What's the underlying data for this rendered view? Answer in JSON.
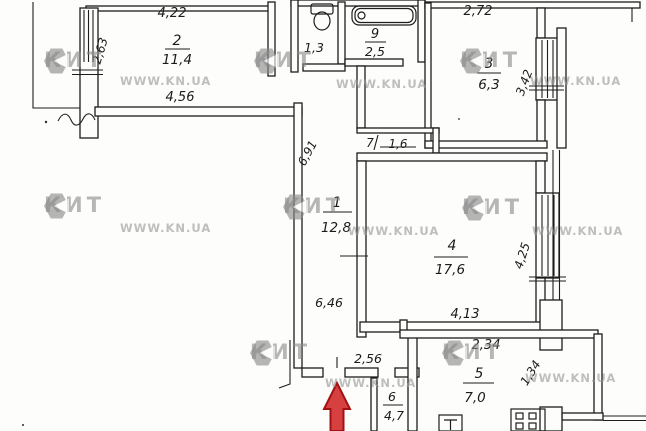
{
  "watermark": {
    "brand": "КИТ",
    "url": "WWW.KN.UA"
  },
  "rooms": {
    "r1": {
      "number": "1",
      "area": "12,8"
    },
    "r2": {
      "number": "2",
      "area": "11,4"
    },
    "r3": {
      "number": "3",
      "area": "6,3"
    },
    "r4": {
      "number": "4",
      "area": "17,6"
    },
    "r5": {
      "number": "5",
      "area": "7,0"
    },
    "r6": {
      "number": "6",
      "area": "4,7"
    },
    "r7": {
      "number": "7",
      "area": "1,6"
    },
    "wc": {
      "area": "1,3"
    },
    "bath": {
      "number": "9",
      "area": "2,5"
    }
  },
  "dimensions": {
    "room2_top": "4,22",
    "room2_left": "2,63",
    "room2_bottom": "4,56",
    "room3_top": "2,72",
    "room3_right": "3,42",
    "corridor_left": "6,91",
    "corridor_bottom": "6,46",
    "room4_right": "4,25",
    "room4_bottom": "4,13",
    "kitchen_top": "2,34",
    "kitchen_right": "1,34",
    "hall_bottom": "2,56"
  }
}
